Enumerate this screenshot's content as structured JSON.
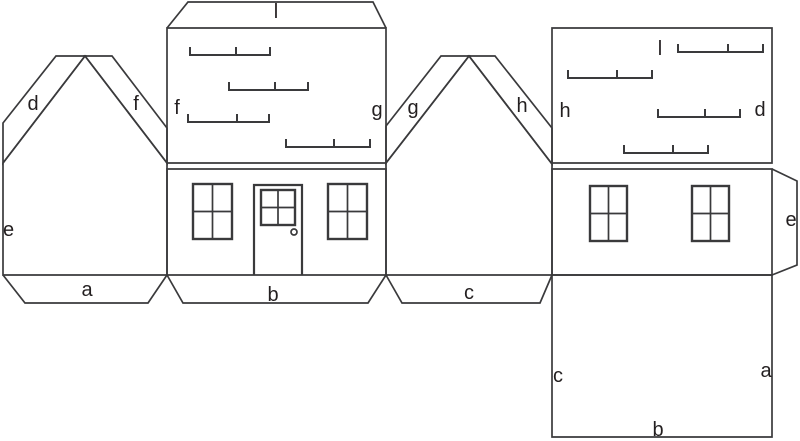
{
  "diagram": {
    "name": "house papercraft net",
    "background_color": "#ffffff",
    "line_color": "#3a3a3c",
    "text_color": "#231f20"
  },
  "labels": {
    "gable_left": {
      "tab_d": "d",
      "tab_f": "f",
      "edge_e": "e",
      "tab_a": "a"
    },
    "front_roof": {
      "ridge_tab": "l",
      "edge_f": "f",
      "edge_g": "g"
    },
    "front_wall": {
      "tab_b": "b"
    },
    "gable_mid": {
      "tab_g": "g",
      "tab_h": "h",
      "tab_c": "c"
    },
    "back_roof": {
      "ridge": "l",
      "edge_h": "h",
      "edge_d": "d"
    },
    "back_wall": {
      "tab_e": "e"
    },
    "base": {
      "edge_c": "c",
      "edge_a": "a",
      "edge_b": "b"
    }
  }
}
